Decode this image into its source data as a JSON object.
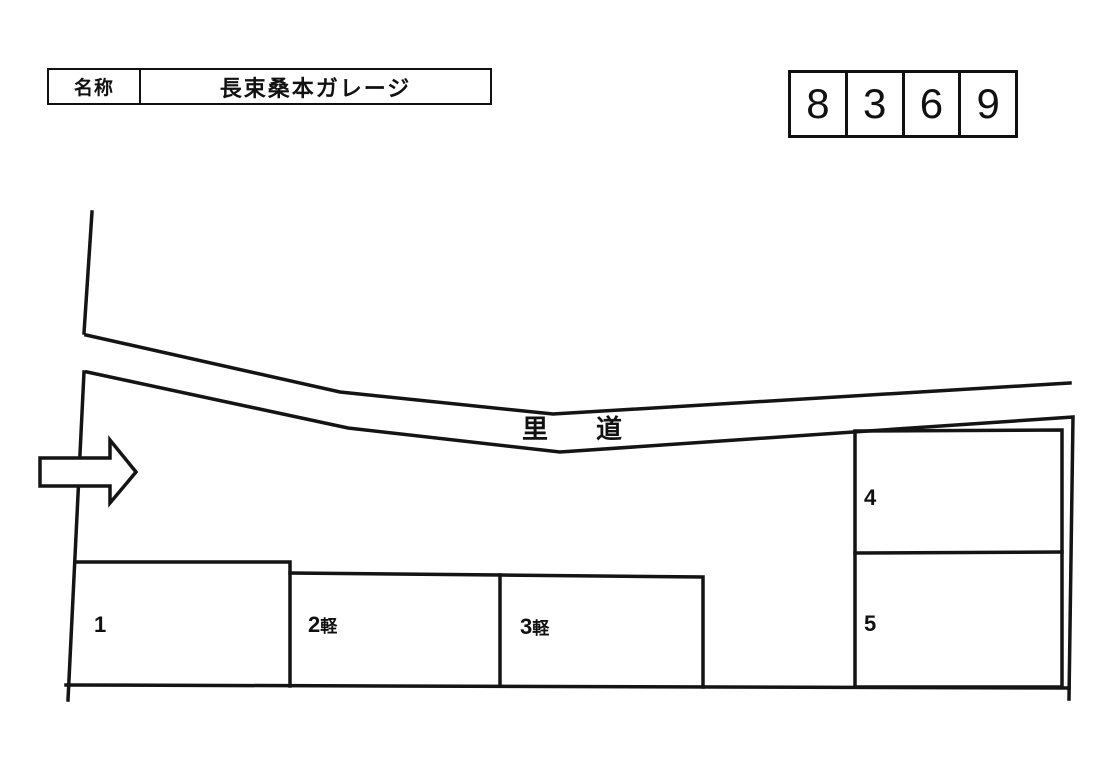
{
  "page": {
    "background_color": "#ffffff",
    "line_color": "#141414"
  },
  "title_box": {
    "label": "名称",
    "value": "長束桑本ガレージ"
  },
  "code_box": {
    "digits": [
      "8",
      "3",
      "6",
      "9"
    ]
  },
  "site_plan": {
    "road": {
      "part1": "里",
      "part2": "道"
    },
    "spaces": [
      {
        "number": "1",
        "suffix": ""
      },
      {
        "number": "2",
        "suffix": "軽"
      },
      {
        "number": "3",
        "suffix": "軽"
      },
      {
        "number": "4",
        "suffix": ""
      },
      {
        "number": "5",
        "suffix": ""
      }
    ],
    "icons": {
      "entrance_arrow": "right-arrow"
    }
  }
}
